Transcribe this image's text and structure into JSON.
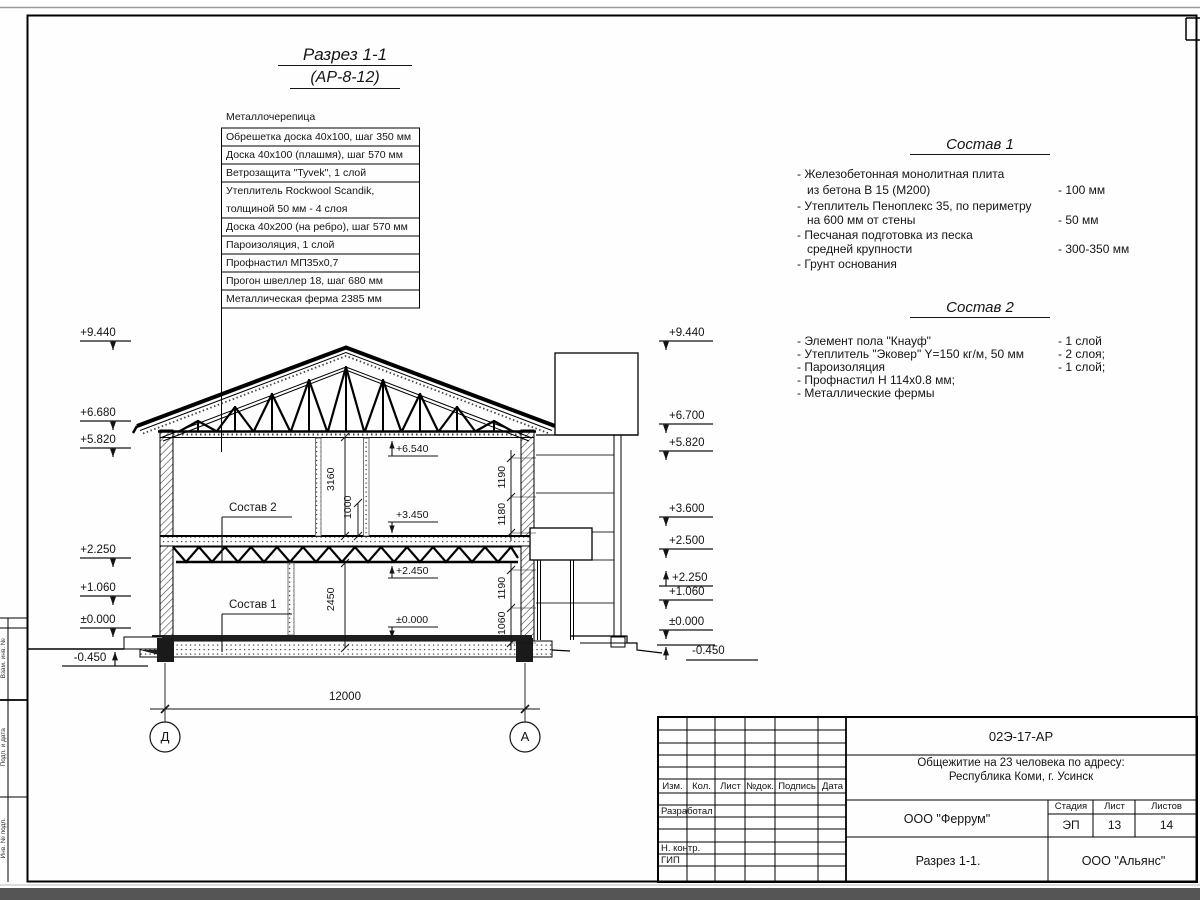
{
  "drawing_title": {
    "line1": "Разрез 1-1",
    "line2": "(АР-8-12)"
  },
  "roof_layers": {
    "top_label": "Металлочерепица",
    "rows": [
      "Обрешетка доска 40х100, шаг 350 мм",
      "Доска 40х100 (плашмя), шаг 570 мм",
      "Ветрозащита \"Tyvek\", 1 слой",
      "Утеплитель Rockwool Scandik,",
      "толщиной 50 мм - 4 слоя",
      "Доска 40х200 (на ребро), шаг 570 мм",
      "Пароизоляция, 1 слой",
      "Профнастил МП35х0,7",
      "Прогон швеллер 18, шаг 680 мм",
      "Металлическая ферма 2385 мм"
    ]
  },
  "sostav1": {
    "heading": "Состав 1",
    "lines": [
      "- Железобетонная  монолитная плита",
      "из бетона В 15 (М200)",
      "- Утеплитель Пеноплекс 35, по периметру",
      "на 600 мм от стены",
      "- Песчаная подготовка из песка",
      "средней крупности",
      "- Грунт основания"
    ],
    "values": [
      "- 100 мм",
      "- 50 мм",
      "- 300-350 мм"
    ]
  },
  "sostav2": {
    "heading": "Состав 2",
    "lines": [
      "- Элемент пола \"Кнауф\"",
      "- Утеплитель \"Эковер\" Y=150 кг/м, 50 мм",
      "- Пароизоляция",
      "- Профнастил Н 114х0.8 мм;",
      "- Металлические фермы"
    ],
    "values": [
      "- 1 слой",
      "- 2 слоя;",
      "- 1 слой;"
    ]
  },
  "elevations": {
    "left": [
      "+9.440",
      "+6.680",
      "+5.820",
      "+2.250",
      "+1.060",
      "±0.000",
      "-0.450"
    ],
    "right": [
      "+9.440",
      "+6.700",
      "+5.820",
      "+3.600",
      "+2.500",
      "+2.250",
      "+1.060",
      "±0.000",
      "-0.450"
    ],
    "interior": [
      "+6.540",
      "+3.450",
      "+2.450",
      "±0.000"
    ]
  },
  "dimensions": {
    "overall": "12000",
    "floor2_height": "3160",
    "floor2_sub": "1000",
    "floor1_height": "2450",
    "right_upper": [
      "1190",
      "1180"
    ],
    "right_lower": [
      "1190",
      "1060"
    ]
  },
  "labels": {
    "sostav2_ref": "Состав 2",
    "sostav1_ref": "Состав 1"
  },
  "axes": {
    "left": "Д",
    "right": "А"
  },
  "titleblock": {
    "doc_number": "02Э-17-АР",
    "project_line1": "Общежитие на 23 человека по адресу:",
    "project_line2": "Республика Коми, г. Усинск",
    "cols": [
      "Изм.",
      "Кол.",
      "Лист",
      "№док.",
      "Подпись",
      "Дата"
    ],
    "rows": [
      "Разработал",
      "Н. контр.",
      "ГИП"
    ],
    "designer": "ООО \"Феррум\"",
    "stage_label": "Стадия",
    "sheet_label": "Лист",
    "sheets_label": "Листов",
    "stage": "ЭП",
    "sheet": "13",
    "sheets": "14",
    "sheet_title": "Разрез 1-1.",
    "company": "ООО \"Альянс\""
  },
  "margin": {
    "labels": [
      "Взам. инв. №",
      "Подп. и дата",
      "Инв. № подл."
    ]
  }
}
